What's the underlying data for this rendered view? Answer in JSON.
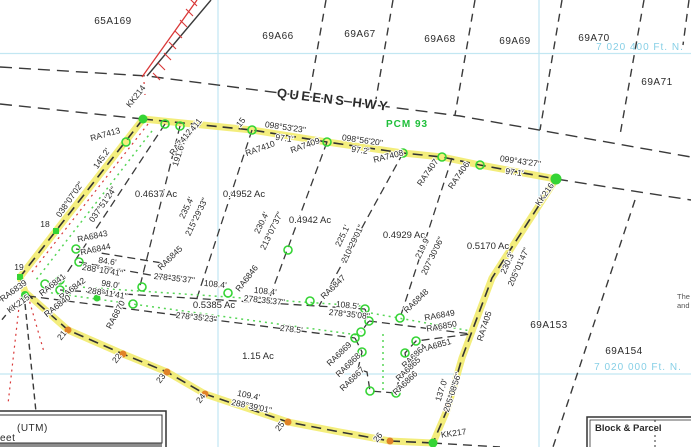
{
  "map": {
    "highway": {
      "name": "QUEENS HWY",
      "plan_ref": "PCM 93"
    },
    "grid": {
      "northing_top": "7 020 400 Ft. N.",
      "northing_bottom": "7 020 000 Ft. N."
    },
    "blocks": {
      "b65A169": "65A169",
      "b69A66": "69A66",
      "b69A67": "69A67",
      "b69A68": "69A68",
      "b69A69": "69A69",
      "b69A70": "69A70",
      "b69A71": "69A71",
      "b69A153": "69A153",
      "b69A154": "69A154"
    },
    "lot_areas": {
      "lot1": "0.4637 Ac",
      "lot2": "0.4952 Ac",
      "lot3": "0.4942 Ac",
      "lot4": "0.4929 Ac",
      "lot5": "0.5170 Ac",
      "strip": "0.5385 Ac",
      "large": "1.15 Ac"
    },
    "monuments": {
      "kk214": "KK214",
      "kk215": "KK215",
      "kk216": "KK216",
      "kk217": "KK217"
    },
    "pins": {
      "ra7413": "RA7413",
      "ra7412": "RA7412",
      "ra7411": "RA7411",
      "ra7410": "RA7410",
      "ra7409": "RA7409",
      "ra7408": "RA7408",
      "ra7407": "RA7407",
      "ra7406": "RA7406",
      "ra7405": "RA7405",
      "ra6839": "RA6839",
      "ra6840": "RA6840",
      "ra6841": "RA6841",
      "ra6842": "RA6842",
      "ra6843": "RA6843",
      "ra6844": "RA6844",
      "ra6845": "RA6845",
      "ra6846": "RA6846",
      "ra6847": "RA6847",
      "ra6848": "RA6848",
      "ra6849": "RA6849",
      "ra6850": "RA6850",
      "ra6851": "RA6851",
      "ra6864": "RA6864",
      "ra6865": "RA6865",
      "ra6866": "RA6866",
      "ra6867": "RA6867",
      "ra6868": "RA6868",
      "ra6869": "RA6869",
      "ra6870": "RA6870"
    },
    "ticks": {
      "t15": "15",
      "t18": "18",
      "t19": "19",
      "t21": "21",
      "t22": "22",
      "t23": "23",
      "t24": "24",
      "t25": "25",
      "t26": "26"
    },
    "dims": {
      "west_brg": "038°07'02\"",
      "west_len": "145.2'",
      "west_inner_brg": "037°51'24\"",
      "d1_len": "191.6'",
      "d2_len": "235.4'",
      "d2_brg": "215°29'33\"",
      "d3_len": "230.4'",
      "d3_brg": "213°07'37\"",
      "d4_len": "225.1'",
      "d4_brg": "210°29'01\"",
      "d5_len": "219.9'",
      "d5_brg": "207°30'06\"",
      "east_len": "230.3'",
      "east_brg": "205°01'47\"",
      "east2_len": "137.0'",
      "east2_brg": "205°08'56\"",
      "hwy1_brg": "098°53'23\"",
      "hwy1_len": "97.1'",
      "hwy2_brg": "098°56'20\"",
      "hwy2_len": "97.2'",
      "hwy3_brg": "099°43'27\"",
      "hwy3_len": "97.1'",
      "u1_brg": "278°35'37\"",
      "u1_len": "108.4'",
      "u2_len": "108.4'",
      "u2_brg": "278°35'37\"",
      "u3_len": "108.5'",
      "u3_brg": "278°35'08\"",
      "l1_brg": "278°35'23\"",
      "l2_len": "278.5'",
      "s1_len": "84.6'",
      "s1_brg": "288°10'41\"",
      "s2_len": "98.0'",
      "s2_brg": "288°11'41\"",
      "bottom_len": "109.4'",
      "bottom_brg": "288°39'01\""
    },
    "legend": {
      "utm": "(UTM)",
      "feet_clipped": "eet",
      "block_parcel": "Block & Parcel"
    },
    "clipped_text": {
      "line1": "The",
      "line2": "and"
    }
  }
}
